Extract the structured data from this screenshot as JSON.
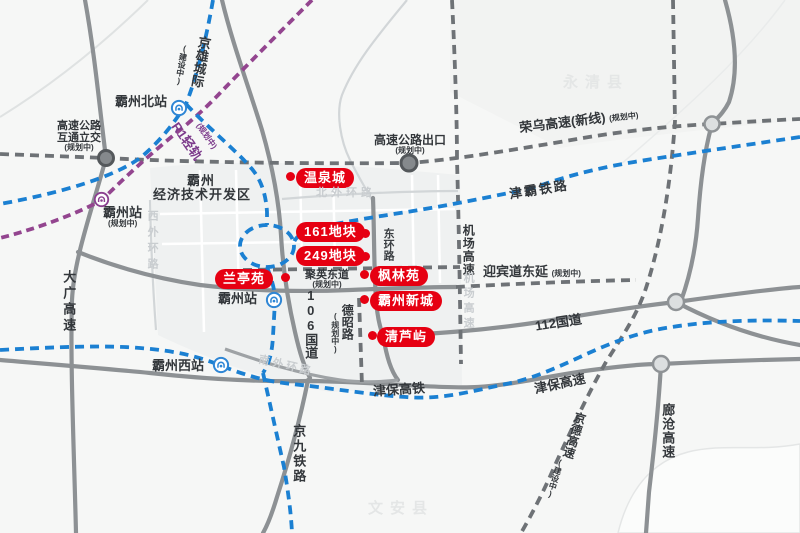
{
  "colors": {
    "accent_red": "#e60012",
    "rail_blue": "#1b80d2",
    "metro_purple": "#93458f",
    "road_gray": "#8d9194",
    "dashed_road_gray": "#6e7276",
    "label_dark": "#33373b",
    "faint_label_gray": "#c9cdd0"
  },
  "watermarks": {
    "yongqing": "永清县",
    "wenan": "文安县"
  },
  "development_zone": {
    "line1": "霸州",
    "line2": "经济技术开发区"
  },
  "venues": [
    {
      "name": "温泉城"
    },
    {
      "name": "161地块"
    },
    {
      "name": "249地块"
    },
    {
      "name": "兰亭苑"
    },
    {
      "name": "枫林苑"
    },
    {
      "name": "霸州新城"
    },
    {
      "name": "清芦屿"
    }
  ],
  "stations": [
    {
      "name": "霸州北站",
      "note": ""
    },
    {
      "name": "霸州站",
      "note": "(规划中)"
    },
    {
      "name": "霸州站",
      "note": ""
    },
    {
      "name": "霸州西站",
      "note": ""
    }
  ],
  "junctions": [
    {
      "line1": "高速公路",
      "line2": "互通立交",
      "note": "(规划中)"
    },
    {
      "name": "高速公路出口",
      "note": "(规划中)"
    }
  ],
  "roads": {
    "jingxiong": {
      "name": "京雄城际",
      "note": "(建设中)"
    },
    "r1": {
      "name": "R1轻轨",
      "note": "(规划中)"
    },
    "rongwu": {
      "name": "荣乌高速(新线)",
      "note": "(规划中)"
    },
    "jinba": {
      "name": "津霸铁路"
    },
    "jichang": {
      "name": "机场高速"
    },
    "jichang_faint": {
      "name": "机场高速"
    },
    "yingbin": {
      "name": "迎宾道东延",
      "note": "(规划中)"
    },
    "g112": {
      "name": "112国道"
    },
    "g106": {
      "name": "106国道"
    },
    "donghuan": {
      "name": "东环路"
    },
    "juying": {
      "name": "聚英东道",
      "note": "(规划中)"
    },
    "dezhao": {
      "name": "德昭路",
      "note": "(规划中)"
    },
    "daguang": {
      "name": "大广高速"
    },
    "jinbao_hsr": {
      "name": "津保高铁"
    },
    "jinbao_exp": {
      "name": "津保高速"
    },
    "jingjiu": {
      "name": "京九铁路"
    },
    "jingde": {
      "name": "京德高速",
      "note": "(建设中)"
    },
    "langcang": {
      "name": "廊沧高速"
    },
    "beiwaihuan": {
      "name": "北外环路"
    },
    "xiwaihuan": {
      "name": "西外环路"
    },
    "nanwaihuan": {
      "name": "南外环路"
    }
  }
}
